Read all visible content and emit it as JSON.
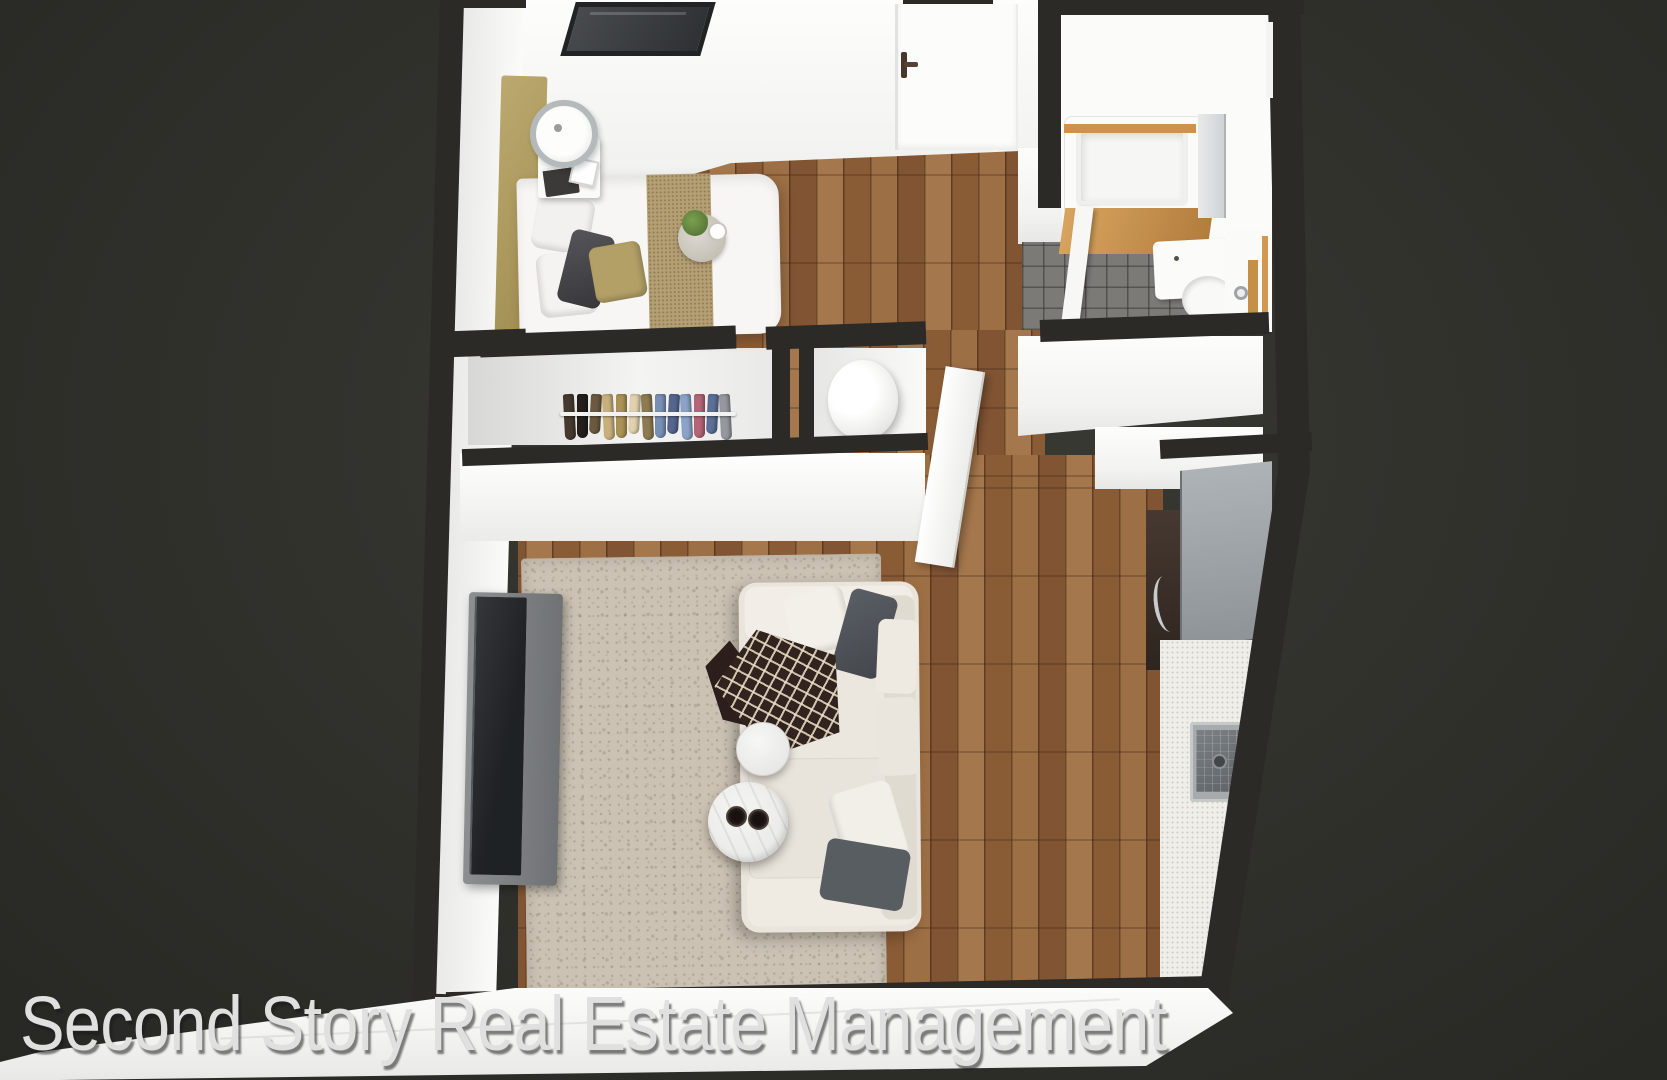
{
  "watermark": {
    "text": "Second Story Real Estate Management"
  },
  "scene": {
    "type": "3d-floor-plan-render",
    "description": "Top-down 3D rendering of a furnished studio apartment on a dark background",
    "rooms": [
      "bedroom",
      "closet",
      "hallway",
      "bathroom",
      "living-room",
      "kitchen",
      "utility-closet"
    ]
  },
  "palette": {
    "background": "#32322d",
    "wall-top": "#2b2a27",
    "wall-white": "#fbfbfa",
    "wood-floor": "#96673f",
    "tile-floor": "#7c7a77",
    "rug": "#cbc2b4",
    "sofa": "#e9e5dd",
    "headboard": "#b3a066",
    "bed-runner": "#b49e74",
    "tub-wood": "#c9944e",
    "tv": "#1f2224",
    "console": "#6f7274",
    "stove": "#8d9397",
    "throw": "#31231e",
    "watermark-color": "#e0e0e0"
  },
  "closet": {
    "garments": [
      "#463a2e",
      "#241f1b",
      "#6b5a40",
      "#c8b07c",
      "#ab9257",
      "#e0d2ae",
      "#8d7c52",
      "#7890b5",
      "#55668e",
      "#8ba3c6",
      "#b56578",
      "#5d6f96",
      "#95999f"
    ]
  },
  "furniture": {
    "bedroom": [
      "double-bed",
      "headboard",
      "nightstand",
      "table-lamp",
      "books",
      "photo-frame",
      "bed-runner",
      "decor-tray",
      "plant",
      "pillows"
    ],
    "closet": [
      "clothes-rod",
      "hanging-clothes"
    ],
    "utility": [
      "water-heater-cylinder",
      "open-door"
    ],
    "bathroom": [
      "bathtub",
      "shower-glass-panel",
      "partition-wall",
      "toilet",
      "vanity-sink",
      "faucet"
    ],
    "living_room": [
      "area-rug",
      "sofa",
      "throw-blanket",
      "coffee-table-small",
      "coffee-table-large",
      "cups",
      "tv",
      "tv-console"
    ],
    "kitchen": [
      "range-cooktop",
      "oven-cabinet",
      "counter",
      "kitchen-sink",
      "faucet"
    ],
    "architecture": [
      "entry-door",
      "interior-door",
      "window",
      "walls"
    ]
  }
}
